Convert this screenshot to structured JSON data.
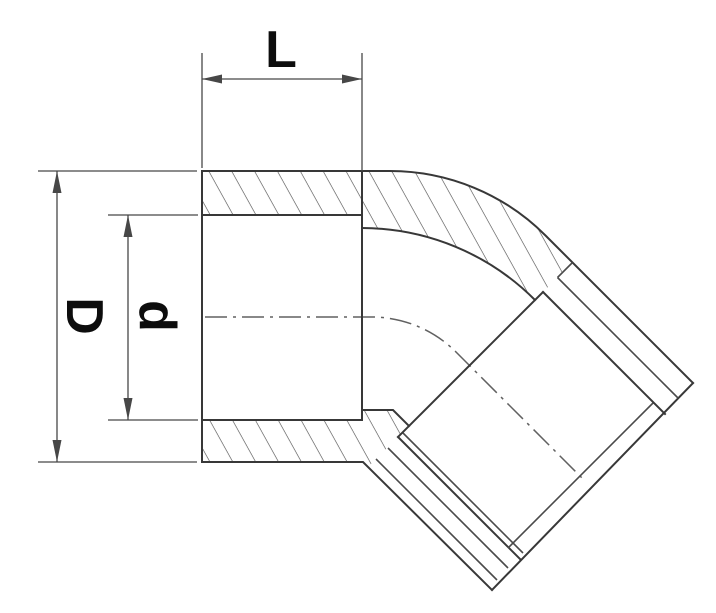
{
  "drawing": {
    "kind": "section-drawing-45-degree-elbow",
    "dimensions": {
      "length": {
        "label": "L"
      },
      "outer_diameter": {
        "label": "D"
      },
      "inner_diameter": {
        "label": "d"
      }
    },
    "colors": {
      "outline": "#383838",
      "secondary_line": "#4a4a4a",
      "hatch": "#4f4f4f",
      "center_line": "#616161",
      "dim_line": "#474747",
      "text": "#0d0d0d",
      "background": "#ffffff"
    }
  }
}
